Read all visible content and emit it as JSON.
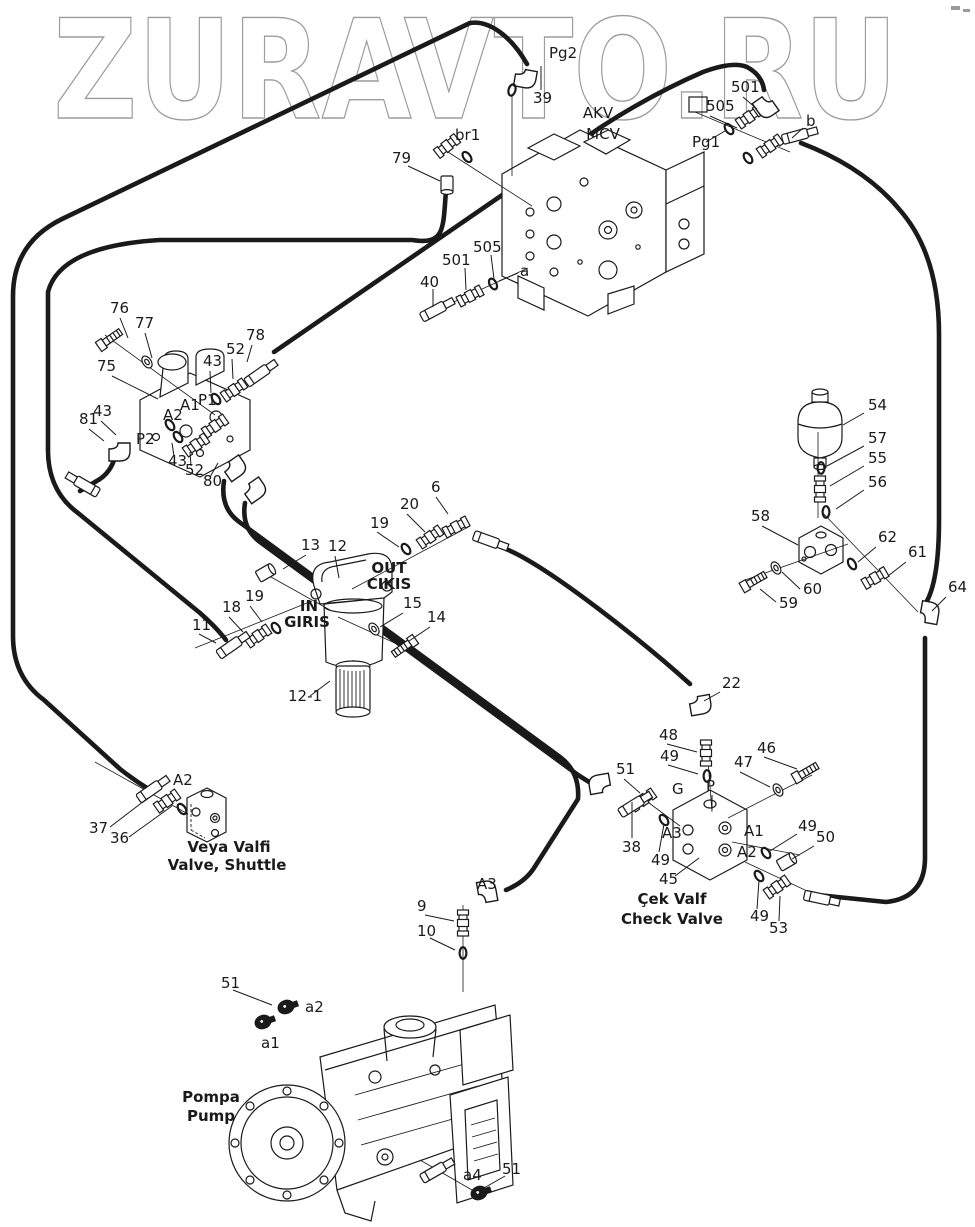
{
  "watermark": {
    "text": "ZURAVTO.RU",
    "color": "#9c9c9c"
  },
  "ink_color": "#1a1a1a",
  "corner_mark": {
    "color": "#9b9b9b"
  },
  "labels": [
    {
      "t": "Pg2",
      "x": 549,
      "y": 58
    },
    {
      "t": "39",
      "x": 533,
      "y": 103
    },
    {
      "t": "br1",
      "x": 455,
      "y": 140
    },
    {
      "t": "79",
      "x": 392,
      "y": 163
    },
    {
      "t": "AKV",
      "x": 598,
      "y": 118,
      "a": "m",
      "s": 17
    },
    {
      "t": "MCV",
      "x": 603,
      "y": 139,
      "a": "m",
      "s": 17
    },
    {
      "t": "505",
      "x": 706,
      "y": 111
    },
    {
      "t": "501",
      "x": 731,
      "y": 92
    },
    {
      "t": "Pg1",
      "x": 692,
      "y": 147
    },
    {
      "t": "b",
      "x": 806,
      "y": 126
    },
    {
      "t": "505",
      "x": 473,
      "y": 252
    },
    {
      "t": "501",
      "x": 442,
      "y": 265
    },
    {
      "t": "40",
      "x": 420,
      "y": 287
    },
    {
      "t": "a",
      "x": 520,
      "y": 276
    },
    {
      "t": "76",
      "x": 110,
      "y": 313
    },
    {
      "t": "77",
      "x": 135,
      "y": 328
    },
    {
      "t": "78",
      "x": 246,
      "y": 340
    },
    {
      "t": "52",
      "x": 226,
      "y": 354
    },
    {
      "t": "43",
      "x": 203,
      "y": 366
    },
    {
      "t": "75",
      "x": 97,
      "y": 371
    },
    {
      "t": "P1",
      "x": 198,
      "y": 405
    },
    {
      "t": "A1",
      "x": 180,
      "y": 410
    },
    {
      "t": "A2",
      "x": 163,
      "y": 420
    },
    {
      "t": "43",
      "x": 93,
      "y": 416
    },
    {
      "t": "81",
      "x": 79,
      "y": 424
    },
    {
      "t": "P2",
      "x": 136,
      "y": 444
    },
    {
      "t": "43",
      "x": 168,
      "y": 466
    },
    {
      "t": "52",
      "x": 185,
      "y": 475
    },
    {
      "t": "80",
      "x": 203,
      "y": 486
    },
    {
      "t": "6",
      "x": 431,
      "y": 492
    },
    {
      "t": "20",
      "x": 400,
      "y": 509
    },
    {
      "t": "19",
      "x": 370,
      "y": 528
    },
    {
      "t": "13",
      "x": 301,
      "y": 550
    },
    {
      "t": "12",
      "x": 328,
      "y": 551
    },
    {
      "t": "OUT",
      "x": 389,
      "y": 573,
      "a": "m",
      "b": 1
    },
    {
      "t": "CIKIS",
      "x": 389,
      "y": 589,
      "a": "m",
      "b": 1
    },
    {
      "t": "IN",
      "x": 309,
      "y": 611,
      "a": "m",
      "b": 1
    },
    {
      "t": "GIRIS",
      "x": 307,
      "y": 627,
      "a": "m",
      "b": 1
    },
    {
      "t": "19",
      "x": 245,
      "y": 601
    },
    {
      "t": "18",
      "x": 222,
      "y": 612
    },
    {
      "t": "11",
      "x": 192,
      "y": 630
    },
    {
      "t": "15",
      "x": 403,
      "y": 608
    },
    {
      "t": "14",
      "x": 427,
      "y": 622
    },
    {
      "t": "12-1",
      "x": 288,
      "y": 701
    },
    {
      "t": "54",
      "x": 868,
      "y": 410
    },
    {
      "t": "57",
      "x": 868,
      "y": 443
    },
    {
      "t": "55",
      "x": 868,
      "y": 463
    },
    {
      "t": "56",
      "x": 868,
      "y": 487
    },
    {
      "t": "58",
      "x": 751,
      "y": 521
    },
    {
      "t": "62",
      "x": 878,
      "y": 542
    },
    {
      "t": "61",
      "x": 908,
      "y": 557
    },
    {
      "t": "64",
      "x": 948,
      "y": 592
    },
    {
      "t": "60",
      "x": 803,
      "y": 594
    },
    {
      "t": "59",
      "x": 779,
      "y": 608
    },
    {
      "t": "22",
      "x": 722,
      "y": 688
    },
    {
      "t": "48",
      "x": 659,
      "y": 740
    },
    {
      "t": "49",
      "x": 660,
      "y": 761
    },
    {
      "t": "46",
      "x": 757,
      "y": 753
    },
    {
      "t": "47",
      "x": 734,
      "y": 767
    },
    {
      "t": "51",
      "x": 616,
      "y": 774
    },
    {
      "t": "G",
      "x": 672,
      "y": 794
    },
    {
      "t": "P",
      "x": 706,
      "y": 791
    },
    {
      "t": "38",
      "x": 622,
      "y": 852
    },
    {
      "t": "A3",
      "x": 662,
      "y": 838
    },
    {
      "t": "49",
      "x": 651,
      "y": 865
    },
    {
      "t": "45",
      "x": 659,
      "y": 884
    },
    {
      "t": "A1",
      "x": 744,
      "y": 836
    },
    {
      "t": "A2",
      "x": 737,
      "y": 857
    },
    {
      "t": "49",
      "x": 798,
      "y": 831
    },
    {
      "t": "50",
      "x": 816,
      "y": 842
    },
    {
      "t": "49",
      "x": 750,
      "y": 921
    },
    {
      "t": "53",
      "x": 769,
      "y": 933
    },
    {
      "t": "Çek Valf",
      "x": 672,
      "y": 904,
      "a": "m",
      "b": 1
    },
    {
      "t": "Check Valve",
      "x": 672,
      "y": 924,
      "a": "m",
      "b": 1
    },
    {
      "t": "A2",
      "x": 173,
      "y": 785
    },
    {
      "t": "37",
      "x": 89,
      "y": 833
    },
    {
      "t": "36",
      "x": 110,
      "y": 843
    },
    {
      "t": "Veya Valfi",
      "x": 229,
      "y": 852,
      "a": "m",
      "b": 1
    },
    {
      "t": "Valve, Shuttle",
      "x": 227,
      "y": 870,
      "a": "m",
      "b": 1
    },
    {
      "t": "A3",
      "x": 477,
      "y": 889
    },
    {
      "t": "9",
      "x": 417,
      "y": 911
    },
    {
      "t": "10",
      "x": 417,
      "y": 936
    },
    {
      "t": "51",
      "x": 221,
      "y": 988
    },
    {
      "t": "a2",
      "x": 305,
      "y": 1012
    },
    {
      "t": "a1",
      "x": 261,
      "y": 1048
    },
    {
      "t": "Pompa",
      "x": 211,
      "y": 1102,
      "a": "m",
      "b": 1,
      "s": 16
    },
    {
      "t": "Pump",
      "x": 211,
      "y": 1121,
      "a": "m",
      "b": 1,
      "s": 16
    },
    {
      "t": "a4",
      "x": 463,
      "y": 1180
    },
    {
      "t": "51",
      "x": 502,
      "y": 1174
    }
  ],
  "leaders": [
    [
      541,
      66,
      541,
      90
    ],
    [
      408,
      166,
      440,
      181
    ],
    [
      743,
      97,
      757,
      109
    ],
    [
      710,
      116,
      737,
      128
    ],
    [
      706,
      142,
      725,
      131
    ],
    [
      803,
      128,
      792,
      138
    ],
    [
      433,
      289,
      433,
      307
    ],
    [
      465,
      268,
      466,
      290
    ],
    [
      491,
      255,
      494,
      279
    ],
    [
      499,
      281,
      518,
      273
    ],
    [
      120,
      318,
      128,
      338
    ],
    [
      145,
      333,
      152,
      358
    ],
    [
      252,
      345,
      247,
      362
    ],
    [
      232,
      359,
      233,
      379
    ],
    [
      210,
      371,
      211,
      393
    ],
    [
      112,
      376,
      158,
      399
    ],
    [
      89,
      429,
      104,
      441
    ],
    [
      101,
      421,
      116,
      435
    ],
    [
      174,
      456,
      172,
      443
    ],
    [
      191,
      466,
      190,
      452
    ],
    [
      210,
      477,
      218,
      463
    ],
    [
      436,
      497,
      448,
      514
    ],
    [
      407,
      514,
      425,
      532
    ],
    [
      377,
      532,
      399,
      547
    ],
    [
      306,
      555,
      283,
      569
    ],
    [
      335,
      556,
      339,
      578
    ],
    [
      403,
      613,
      380,
      627
    ],
    [
      430,
      627,
      409,
      641
    ],
    [
      250,
      606,
      262,
      622
    ],
    [
      229,
      617,
      243,
      632
    ],
    [
      199,
      634,
      216,
      643
    ],
    [
      310,
      696,
      330,
      681
    ],
    [
      864,
      413,
      843,
      425
    ],
    [
      864,
      446,
      827,
      466
    ],
    [
      864,
      466,
      830,
      486
    ],
    [
      864,
      490,
      836,
      509
    ],
    [
      762,
      526,
      798,
      545
    ],
    [
      876,
      547,
      858,
      562
    ],
    [
      906,
      562,
      888,
      576
    ],
    [
      946,
      597,
      932,
      611
    ],
    [
      800,
      589,
      782,
      572
    ],
    [
      776,
      602,
      760,
      589
    ],
    [
      720,
      692,
      704,
      701
    ],
    [
      667,
      744,
      697,
      752
    ],
    [
      668,
      765,
      698,
      774
    ],
    [
      764,
      757,
      797,
      769
    ],
    [
      740,
      772,
      770,
      787
    ],
    [
      624,
      779,
      640,
      793
    ],
    [
      712,
      795,
      712,
      810
    ],
    [
      632,
      802,
      632,
      838
    ],
    [
      659,
      852,
      664,
      824
    ],
    [
      675,
      876,
      699,
      858
    ],
    [
      797,
      834,
      770,
      851
    ],
    [
      814,
      846,
      792,
      859
    ],
    [
      757,
      909,
      759,
      880
    ],
    [
      779,
      921,
      780,
      896
    ],
    [
      110,
      827,
      148,
      798
    ],
    [
      129,
      837,
      172,
      806
    ],
    [
      425,
      915,
      454,
      921
    ],
    [
      430,
      938,
      455,
      950
    ],
    [
      233,
      990,
      272,
      1005
    ],
    [
      505,
      1176,
      484,
      1188
    ]
  ],
  "axes": [
    [
      105,
      335,
      215,
      415
    ],
    [
      262,
      572,
      330,
      610
    ],
    [
      195,
      648,
      312,
      601
    ],
    [
      352,
      589,
      470,
      526
    ],
    [
      410,
      650,
      338,
      617
    ],
    [
      745,
      580,
      848,
      544
    ],
    [
      822,
      512,
      918,
      612
    ],
    [
      707,
      748,
      712,
      812
    ],
    [
      812,
      775,
      728,
      818
    ],
    [
      645,
      800,
      680,
      826
    ],
    [
      800,
      855,
      732,
      842
    ],
    [
      745,
      862,
      820,
      897
    ],
    [
      448,
      152,
      532,
      206
    ],
    [
      432,
      312,
      528,
      268
    ],
    [
      695,
      112,
      790,
      152
    ],
    [
      512,
      96,
      512,
      176
    ],
    [
      463,
      905,
      463,
      992
    ],
    [
      420,
      1160,
      472,
      1190
    ],
    [
      95,
      762,
      188,
      814
    ],
    [
      818,
      432,
      818,
      518
    ]
  ],
  "fittings": [
    {
      "k": "elbow",
      "x": 522,
      "y": 72,
      "r": 100
    },
    {
      "k": "oring",
      "x": 512,
      "y": 90,
      "r": 15
    },
    {
      "k": "nipple",
      "x": 447,
      "y": 146,
      "r": -38
    },
    {
      "k": "oring",
      "x": 467,
      "y": 157,
      "r": -38
    },
    {
      "k": "plug",
      "x": 447,
      "y": 184,
      "r": 90
    },
    {
      "k": "sleeve",
      "x": 434,
      "y": 311,
      "r": -28
    },
    {
      "k": "nipple",
      "x": 470,
      "y": 296,
      "r": -28
    },
    {
      "k": "oring",
      "x": 493,
      "y": 284,
      "r": -28
    },
    {
      "k": "square",
      "x": 698,
      "y": 105
    },
    {
      "k": "oring",
      "x": 729,
      "y": 129,
      "r": -35
    },
    {
      "k": "nipple",
      "x": 749,
      "y": 117,
      "r": -35
    },
    {
      "k": "elbow",
      "x": 768,
      "y": 100,
      "r": 145
    },
    {
      "k": "oring",
      "x": 748,
      "y": 158,
      "r": -35
    },
    {
      "k": "nipple",
      "x": 770,
      "y": 146,
      "r": -35
    },
    {
      "k": "sleeve",
      "x": 796,
      "y": 136,
      "r": -15
    },
    {
      "k": "bolt",
      "x": 110,
      "y": 339,
      "r": -35
    },
    {
      "k": "washer",
      "x": 147,
      "y": 362,
      "r": -35
    },
    {
      "k": "oring",
      "x": 216,
      "y": 399,
      "r": -35
    },
    {
      "k": "nipple",
      "x": 234,
      "y": 390,
      "r": -35
    },
    {
      "k": "sleeve",
      "x": 258,
      "y": 375,
      "r": -35
    },
    {
      "k": "oring",
      "x": 170,
      "y": 425,
      "r": -35
    },
    {
      "k": "elbow",
      "x": 115,
      "y": 446,
      "r": 90
    },
    {
      "k": "sleeve",
      "x": 86,
      "y": 486,
      "r": -150
    },
    {
      "k": "oring",
      "x": 178,
      "y": 437,
      "r": -35
    },
    {
      "k": "nipple",
      "x": 196,
      "y": 445,
      "r": -35
    },
    {
      "k": "nipple",
      "x": 215,
      "y": 426,
      "r": -35
    },
    {
      "k": "elbow",
      "x": 228,
      "y": 466,
      "r": 55
    },
    {
      "k": "elbow",
      "x": 248,
      "y": 488,
      "r": 55
    },
    {
      "k": "plug",
      "x": 265,
      "y": 573,
      "r": -30
    },
    {
      "k": "oring",
      "x": 276,
      "y": 628,
      "r": -35
    },
    {
      "k": "nipple",
      "x": 258,
      "y": 636,
      "r": -35
    },
    {
      "k": "sleeve",
      "x": 230,
      "y": 647,
      "r": -35
    },
    {
      "k": "oring",
      "x": 406,
      "y": 549,
      "r": -35
    },
    {
      "k": "nipple",
      "x": 430,
      "y": 537,
      "r": -35
    },
    {
      "k": "nipple",
      "x": 456,
      "y": 527,
      "r": -28
    },
    {
      "k": "sleeve",
      "x": 487,
      "y": 540,
      "r": 20
    },
    {
      "k": "washer",
      "x": 374,
      "y": 629,
      "r": -35
    },
    {
      "k": "bolt",
      "x": 404,
      "y": 647,
      "r": 145
    },
    {
      "k": "oring",
      "x": 821,
      "y": 468,
      "r": 0
    },
    {
      "k": "nipple",
      "x": 820,
      "y": 489,
      "r": 90
    },
    {
      "k": "oring",
      "x": 826,
      "y": 512,
      "r": 0
    },
    {
      "k": "bolt",
      "x": 754,
      "y": 581,
      "r": -30
    },
    {
      "k": "washer",
      "x": 776,
      "y": 568,
      "r": -30
    },
    {
      "k": "oring",
      "x": 852,
      "y": 564,
      "r": -30
    },
    {
      "k": "nipple",
      "x": 875,
      "y": 578,
      "r": -30
    },
    {
      "k": "elbow",
      "x": 923,
      "y": 616,
      "r": 10
    },
    {
      "k": "elbow",
      "x": 695,
      "y": 700,
      "r": 80
    },
    {
      "k": "nipple",
      "x": 706,
      "y": 753,
      "r": 90
    },
    {
      "k": "oring",
      "x": 707,
      "y": 776,
      "r": 0
    },
    {
      "k": "bolt",
      "x": 806,
      "y": 772,
      "r": -30
    },
    {
      "k": "washer",
      "x": 778,
      "y": 790,
      "r": -30
    },
    {
      "k": "elbow",
      "x": 605,
      "y": 789,
      "r": -100
    },
    {
      "k": "nipple",
      "x": 643,
      "y": 800,
      "r": -35
    },
    {
      "k": "sleeve",
      "x": 632,
      "y": 806,
      "r": -32
    },
    {
      "k": "oring",
      "x": 664,
      "y": 820,
      "r": -35
    },
    {
      "k": "oring",
      "x": 766,
      "y": 853,
      "r": -35
    },
    {
      "k": "plug",
      "x": 786,
      "y": 862,
      "r": -30
    },
    {
      "k": "oring",
      "x": 759,
      "y": 876,
      "r": -35
    },
    {
      "k": "nipple",
      "x": 777,
      "y": 887,
      "r": -35
    },
    {
      "k": "sleeve",
      "x": 818,
      "y": 898,
      "r": 12
    },
    {
      "k": "sleeve",
      "x": 150,
      "y": 791,
      "r": -35
    },
    {
      "k": "nipple",
      "x": 167,
      "y": 801,
      "r": -35
    },
    {
      "k": "oring",
      "x": 182,
      "y": 809,
      "r": -35
    },
    {
      "k": "elbow",
      "x": 482,
      "y": 897,
      "r": -10
    },
    {
      "k": "nipple",
      "x": 463,
      "y": 923,
      "r": 90
    },
    {
      "k": "oring",
      "x": 463,
      "y": 953,
      "r": 0
    },
    {
      "k": "clamp",
      "x": 286,
      "y": 1007,
      "r": -20
    },
    {
      "k": "clamp",
      "x": 263,
      "y": 1022,
      "r": -20
    },
    {
      "k": "clamp",
      "x": 479,
      "y": 1193,
      "r": -20
    },
    {
      "k": "sleeve",
      "x": 434,
      "y": 1172,
      "r": -30
    }
  ]
}
